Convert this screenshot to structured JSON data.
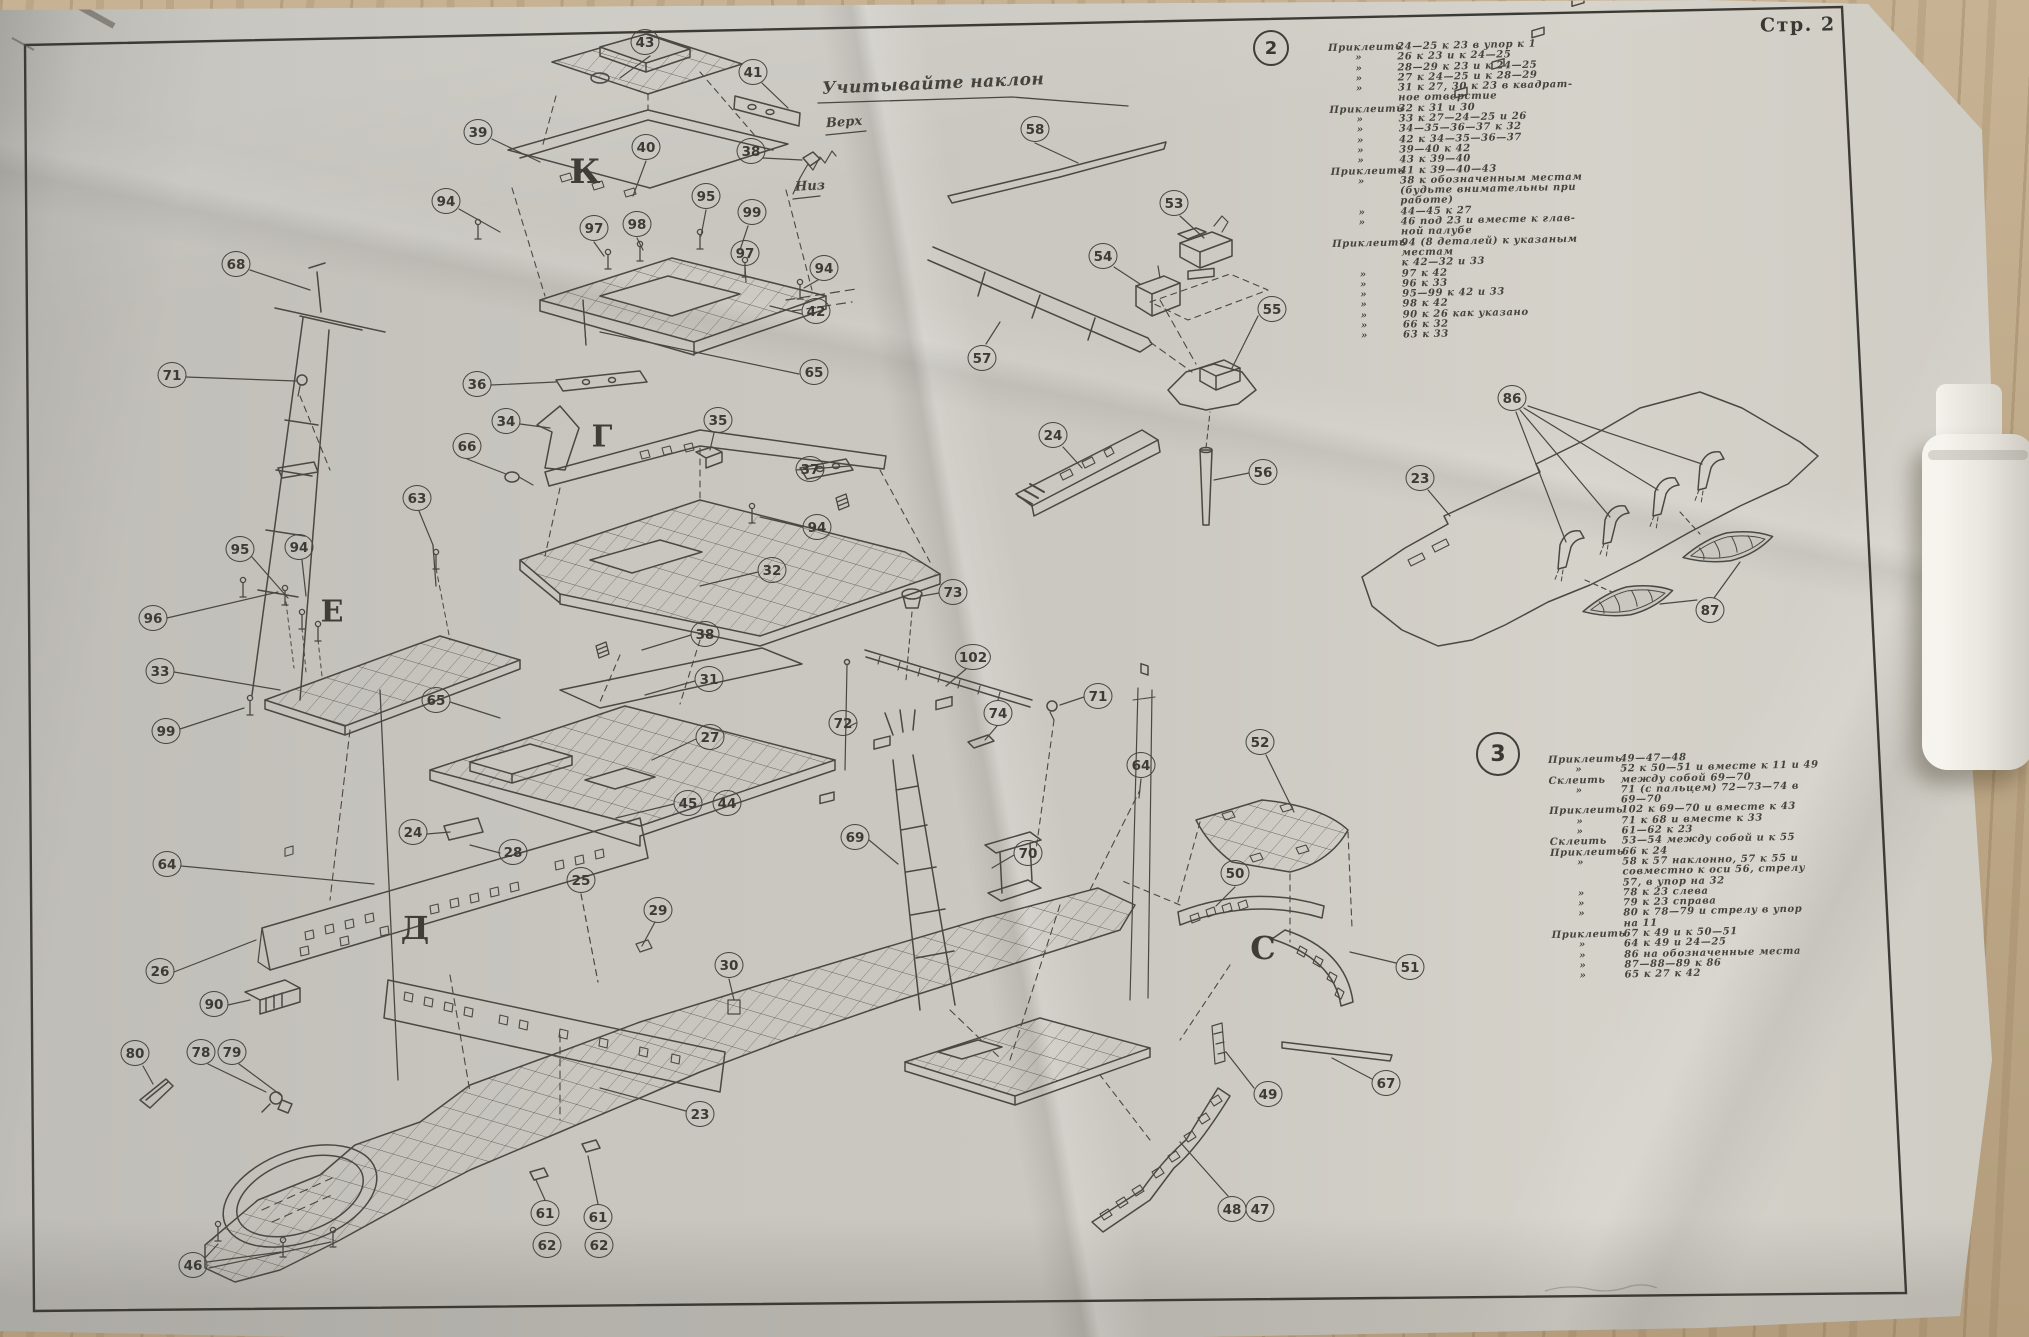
{
  "page": {
    "label": "Стр. 2"
  },
  "annotations": {
    "tilt_note": "Учитывайте наклон",
    "up": "Верх",
    "down": "Низ"
  },
  "colors": {
    "ink": "#4b4843",
    "paper": "#cbc8c1",
    "wood": "#bda887"
  },
  "sections": [
    {
      "id": "2",
      "lines": [
        {
          "lead": "Приклеить",
          "body": "24—25 к 23 в упор к 1"
        },
        {
          "lead": "»",
          "body": "26 к 23 и к 24—25"
        },
        {
          "lead": "»",
          "body": "28—29 к 23 и к 24—25"
        },
        {
          "lead": "»",
          "body": "27 к 24—25 и к 28—29"
        },
        {
          "lead": "»",
          "body": "31 к 27, 30 к 23 в квадрат-"
        },
        {
          "lead": "",
          "body": "ное отверстие"
        },
        {
          "lead": "Приклеить",
          "body": "32 к 31 и 30"
        },
        {
          "lead": "»",
          "body": "33 к 27—24—25 и 26"
        },
        {
          "lead": "»",
          "body": "34—35—36—37 к 32"
        },
        {
          "lead": "»",
          "body": "42 к 34—35—36—37"
        },
        {
          "lead": "»",
          "body": "39—40 к 42"
        },
        {
          "lead": "»",
          "body": "43 к 39—40"
        },
        {
          "lead": "Приклеить",
          "body": "41 к 39—40—43"
        },
        {
          "lead": "»",
          "body": "38 к обозначенным местам"
        },
        {
          "lead": "",
          "body": "(будьте внимательны при"
        },
        {
          "lead": "",
          "body": "работе)"
        },
        {
          "lead": "»",
          "body": "44—45 к 27"
        },
        {
          "lead": "»",
          "body": "46 под 23 и вместе к глав-"
        },
        {
          "lead": "",
          "body": "ной палубе"
        },
        {
          "lead": "Приклеить",
          "body": "94 (8 деталей) к указаным"
        },
        {
          "lead": "",
          "body": "местам"
        },
        {
          "lead": "",
          "body": "к 42—32 и 33"
        },
        {
          "lead": "»",
          "body": "97 к 42"
        },
        {
          "lead": "»",
          "body": "96 к 33"
        },
        {
          "lead": "»",
          "body": "95—99 к 42 и 33"
        },
        {
          "lead": "»",
          "body": "98 к 42"
        },
        {
          "lead": "»",
          "body": "90 к 26 как указано"
        },
        {
          "lead": "»",
          "body": "66 к 32"
        },
        {
          "lead": "»",
          "body": "63 к 33"
        }
      ]
    },
    {
      "id": "3",
      "lines": [
        {
          "lead": "Приклеить",
          "body": "49—47—48"
        },
        {
          "lead": "»",
          "body": "52 к 50—51 и вместе к 11 и 49"
        },
        {
          "lead": "Склеить",
          "body": "между собой 69—70"
        },
        {
          "lead": "»",
          "body": "71 (с пальцем) 72—73—74 в"
        },
        {
          "lead": "",
          "body": "69—70"
        },
        {
          "lead": "Приклеить",
          "body": "102 к 69—70 и вместе к 43"
        },
        {
          "lead": "»",
          "body": "71 к 68 и вместе к 33"
        },
        {
          "lead": "»",
          "body": "61—62 к 23"
        },
        {
          "lead": "Склеить",
          "body": "53—54 между собой и к 55"
        },
        {
          "lead": "Приклеить",
          "body": "66 к 24"
        },
        {
          "lead": "»",
          "body": "58 к 57 наклонно, 57 к 55 и"
        },
        {
          "lead": "",
          "body": "совместно к оси 56, стрелу"
        },
        {
          "lead": "",
          "body": "57, в упор на 32"
        },
        {
          "lead": "»",
          "body": "78 к 23 слева"
        },
        {
          "lead": "»",
          "body": "79 к 23 справа"
        },
        {
          "lead": "»",
          "body": "80 к 78—79 и стрелу в упор"
        },
        {
          "lead": "",
          "body": "на 11"
        },
        {
          "lead": "Приклеить",
          "body": "67 к 49 и к 50—51"
        },
        {
          "lead": "»",
          "body": "64 к 49 и 24—25"
        },
        {
          "lead": "»",
          "body": "86 на обозначенные места"
        },
        {
          "lead": "»",
          "body": "87—88—89 к 86"
        },
        {
          "lead": "»",
          "body": "65 к 27 к 42"
        }
      ]
    }
  ],
  "letters": [
    {
      "ch": "К",
      "x": 585,
      "y": 172,
      "size": 34
    },
    {
      "ch": "Г",
      "x": 602,
      "y": 437,
      "size": 30
    },
    {
      "ch": "Е",
      "x": 332,
      "y": 612,
      "size": 30
    },
    {
      "ch": "Д",
      "x": 415,
      "y": 928,
      "size": 32
    },
    {
      "ch": "С",
      "x": 1263,
      "y": 948,
      "size": 32
    }
  ],
  "callouts": [
    {
      "n": "43",
      "x": 645,
      "y": 42
    },
    {
      "n": "41",
      "x": 753,
      "y": 72
    },
    {
      "n": "39",
      "x": 478,
      "y": 132
    },
    {
      "n": "40",
      "x": 646,
      "y": 147
    },
    {
      "n": "38",
      "x": 751,
      "y": 151
    },
    {
      "n": "94",
      "x": 446,
      "y": 201
    },
    {
      "n": "95",
      "x": 706,
      "y": 196
    },
    {
      "n": "97",
      "x": 594,
      "y": 228
    },
    {
      "n": "98",
      "x": 637,
      "y": 224
    },
    {
      "n": "99",
      "x": 752,
      "y": 212
    },
    {
      "n": "97",
      "x": 745,
      "y": 253
    },
    {
      "n": "94",
      "x": 824,
      "y": 268
    },
    {
      "n": "68",
      "x": 236,
      "y": 264
    },
    {
      "n": "42",
      "x": 816,
      "y": 311
    },
    {
      "n": "65",
      "x": 814,
      "y": 372
    },
    {
      "n": "71",
      "x": 172,
      "y": 375
    },
    {
      "n": "36",
      "x": 477,
      "y": 384
    },
    {
      "n": "34",
      "x": 506,
      "y": 421
    },
    {
      "n": "35",
      "x": 718,
      "y": 420
    },
    {
      "n": "66",
      "x": 467,
      "y": 446
    },
    {
      "n": "37",
      "x": 810,
      "y": 469
    },
    {
      "n": "63",
      "x": 417,
      "y": 498
    },
    {
      "n": "94",
      "x": 817,
      "y": 527
    },
    {
      "n": "32",
      "x": 772,
      "y": 570
    },
    {
      "n": "95",
      "x": 240,
      "y": 549
    },
    {
      "n": "94",
      "x": 299,
      "y": 547
    },
    {
      "n": "96",
      "x": 153,
      "y": 618
    },
    {
      "n": "38",
      "x": 705,
      "y": 634
    },
    {
      "n": "33",
      "x": 160,
      "y": 671
    },
    {
      "n": "31",
      "x": 709,
      "y": 679
    },
    {
      "n": "65",
      "x": 436,
      "y": 700
    },
    {
      "n": "99",
      "x": 166,
      "y": 731
    },
    {
      "n": "27",
      "x": 710,
      "y": 737
    },
    {
      "n": "45",
      "x": 688,
      "y": 803
    },
    {
      "n": "44",
      "x": 727,
      "y": 803
    },
    {
      "n": "24",
      "x": 413,
      "y": 832
    },
    {
      "n": "28",
      "x": 513,
      "y": 852
    },
    {
      "n": "64",
      "x": 167,
      "y": 864
    },
    {
      "n": "25",
      "x": 581,
      "y": 880
    },
    {
      "n": "29",
      "x": 658,
      "y": 910
    },
    {
      "n": "30",
      "x": 729,
      "y": 965
    },
    {
      "n": "26",
      "x": 160,
      "y": 971
    },
    {
      "n": "90",
      "x": 214,
      "y": 1004
    },
    {
      "n": "80",
      "x": 135,
      "y": 1053
    },
    {
      "n": "78",
      "x": 201,
      "y": 1052
    },
    {
      "n": "79",
      "x": 232,
      "y": 1052
    },
    {
      "n": "23",
      "x": 700,
      "y": 1114
    },
    {
      "n": "61",
      "x": 545,
      "y": 1213
    },
    {
      "n": "62",
      "x": 547,
      "y": 1245
    },
    {
      "n": "61",
      "x": 598,
      "y": 1217
    },
    {
      "n": "62",
      "x": 599,
      "y": 1245
    },
    {
      "n": "46",
      "x": 193,
      "y": 1265
    },
    {
      "n": "58",
      "x": 1035,
      "y": 129
    },
    {
      "n": "53",
      "x": 1174,
      "y": 203
    },
    {
      "n": "54",
      "x": 1103,
      "y": 256
    },
    {
      "n": "55",
      "x": 1272,
      "y": 309
    },
    {
      "n": "57",
      "x": 982,
      "y": 358
    },
    {
      "n": "24",
      "x": 1053,
      "y": 435
    },
    {
      "n": "56",
      "x": 1263,
      "y": 472
    },
    {
      "n": "73",
      "x": 953,
      "y": 592
    },
    {
      "n": "102",
      "x": 973,
      "y": 657
    },
    {
      "n": "71",
      "x": 1098,
      "y": 696
    },
    {
      "n": "74",
      "x": 998,
      "y": 713
    },
    {
      "n": "72",
      "x": 843,
      "y": 723
    },
    {
      "n": "52",
      "x": 1260,
      "y": 742
    },
    {
      "n": "64",
      "x": 1141,
      "y": 765
    },
    {
      "n": "69",
      "x": 855,
      "y": 837
    },
    {
      "n": "70",
      "x": 1028,
      "y": 853
    },
    {
      "n": "50",
      "x": 1235,
      "y": 873
    },
    {
      "n": "51",
      "x": 1410,
      "y": 967
    },
    {
      "n": "67",
      "x": 1386,
      "y": 1083
    },
    {
      "n": "49",
      "x": 1268,
      "y": 1094
    },
    {
      "n": "48",
      "x": 1232,
      "y": 1209
    },
    {
      "n": "47",
      "x": 1260,
      "y": 1209
    },
    {
      "n": "86",
      "x": 1512,
      "y": 398
    },
    {
      "n": "23",
      "x": 1420,
      "y": 478
    },
    {
      "n": "87",
      "x": 1710,
      "y": 610
    }
  ]
}
